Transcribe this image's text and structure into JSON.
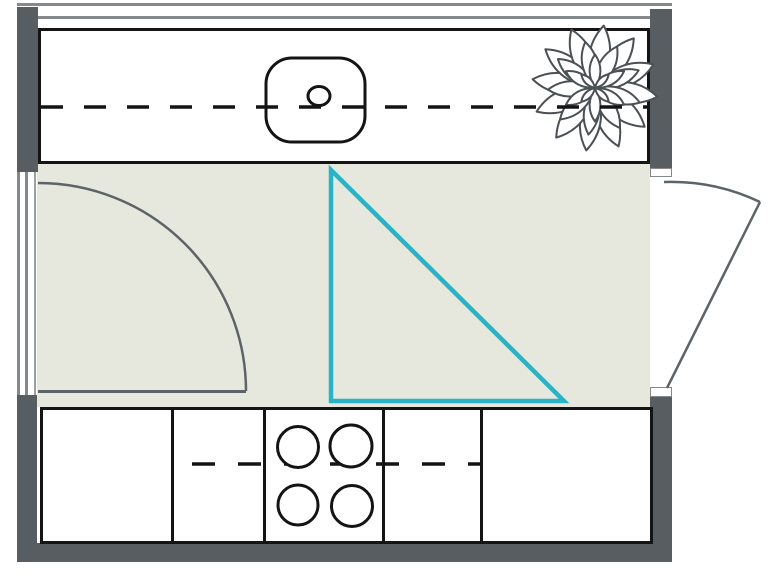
{
  "title": "Kitchen floor plan",
  "colors": {
    "background": "#ffffff",
    "wall": "#575d61",
    "floor": "#e6e8de",
    "line": "#141414",
    "door_line": "#5d6366",
    "window_line": "#85898b",
    "window_line_light": "#9ba0a2",
    "work_triangle": "#2ab3c5",
    "plant_line": "#4b5054"
  },
  "elements": {
    "top_counter": "counter-with-sink",
    "bottom_counter": "counter-with-cooktop",
    "sink": "sink-basin",
    "faucet": "faucet-hole",
    "cooktop_burner_count": 4,
    "plant": "potted-plant",
    "work_triangle": "kitchen-work-triangle",
    "left_door": "door-swinging-inward",
    "right_door": "door-swinging-outward",
    "windows": [
      "top-window",
      "left-window"
    ],
    "counter_center_dashes": [
      "top-counter-centerline",
      "bottom-counter-centerline"
    ]
  },
  "plant_rings": [
    {
      "petals": 12,
      "scale": 1.5,
      "offset": 8
    },
    {
      "petals": 9,
      "scale": 1.12,
      "offset": 28
    },
    {
      "petals": 6,
      "scale": 0.8,
      "offset": 0
    },
    {
      "petals": 4,
      "scale": 0.46,
      "offset": 45
    }
  ]
}
